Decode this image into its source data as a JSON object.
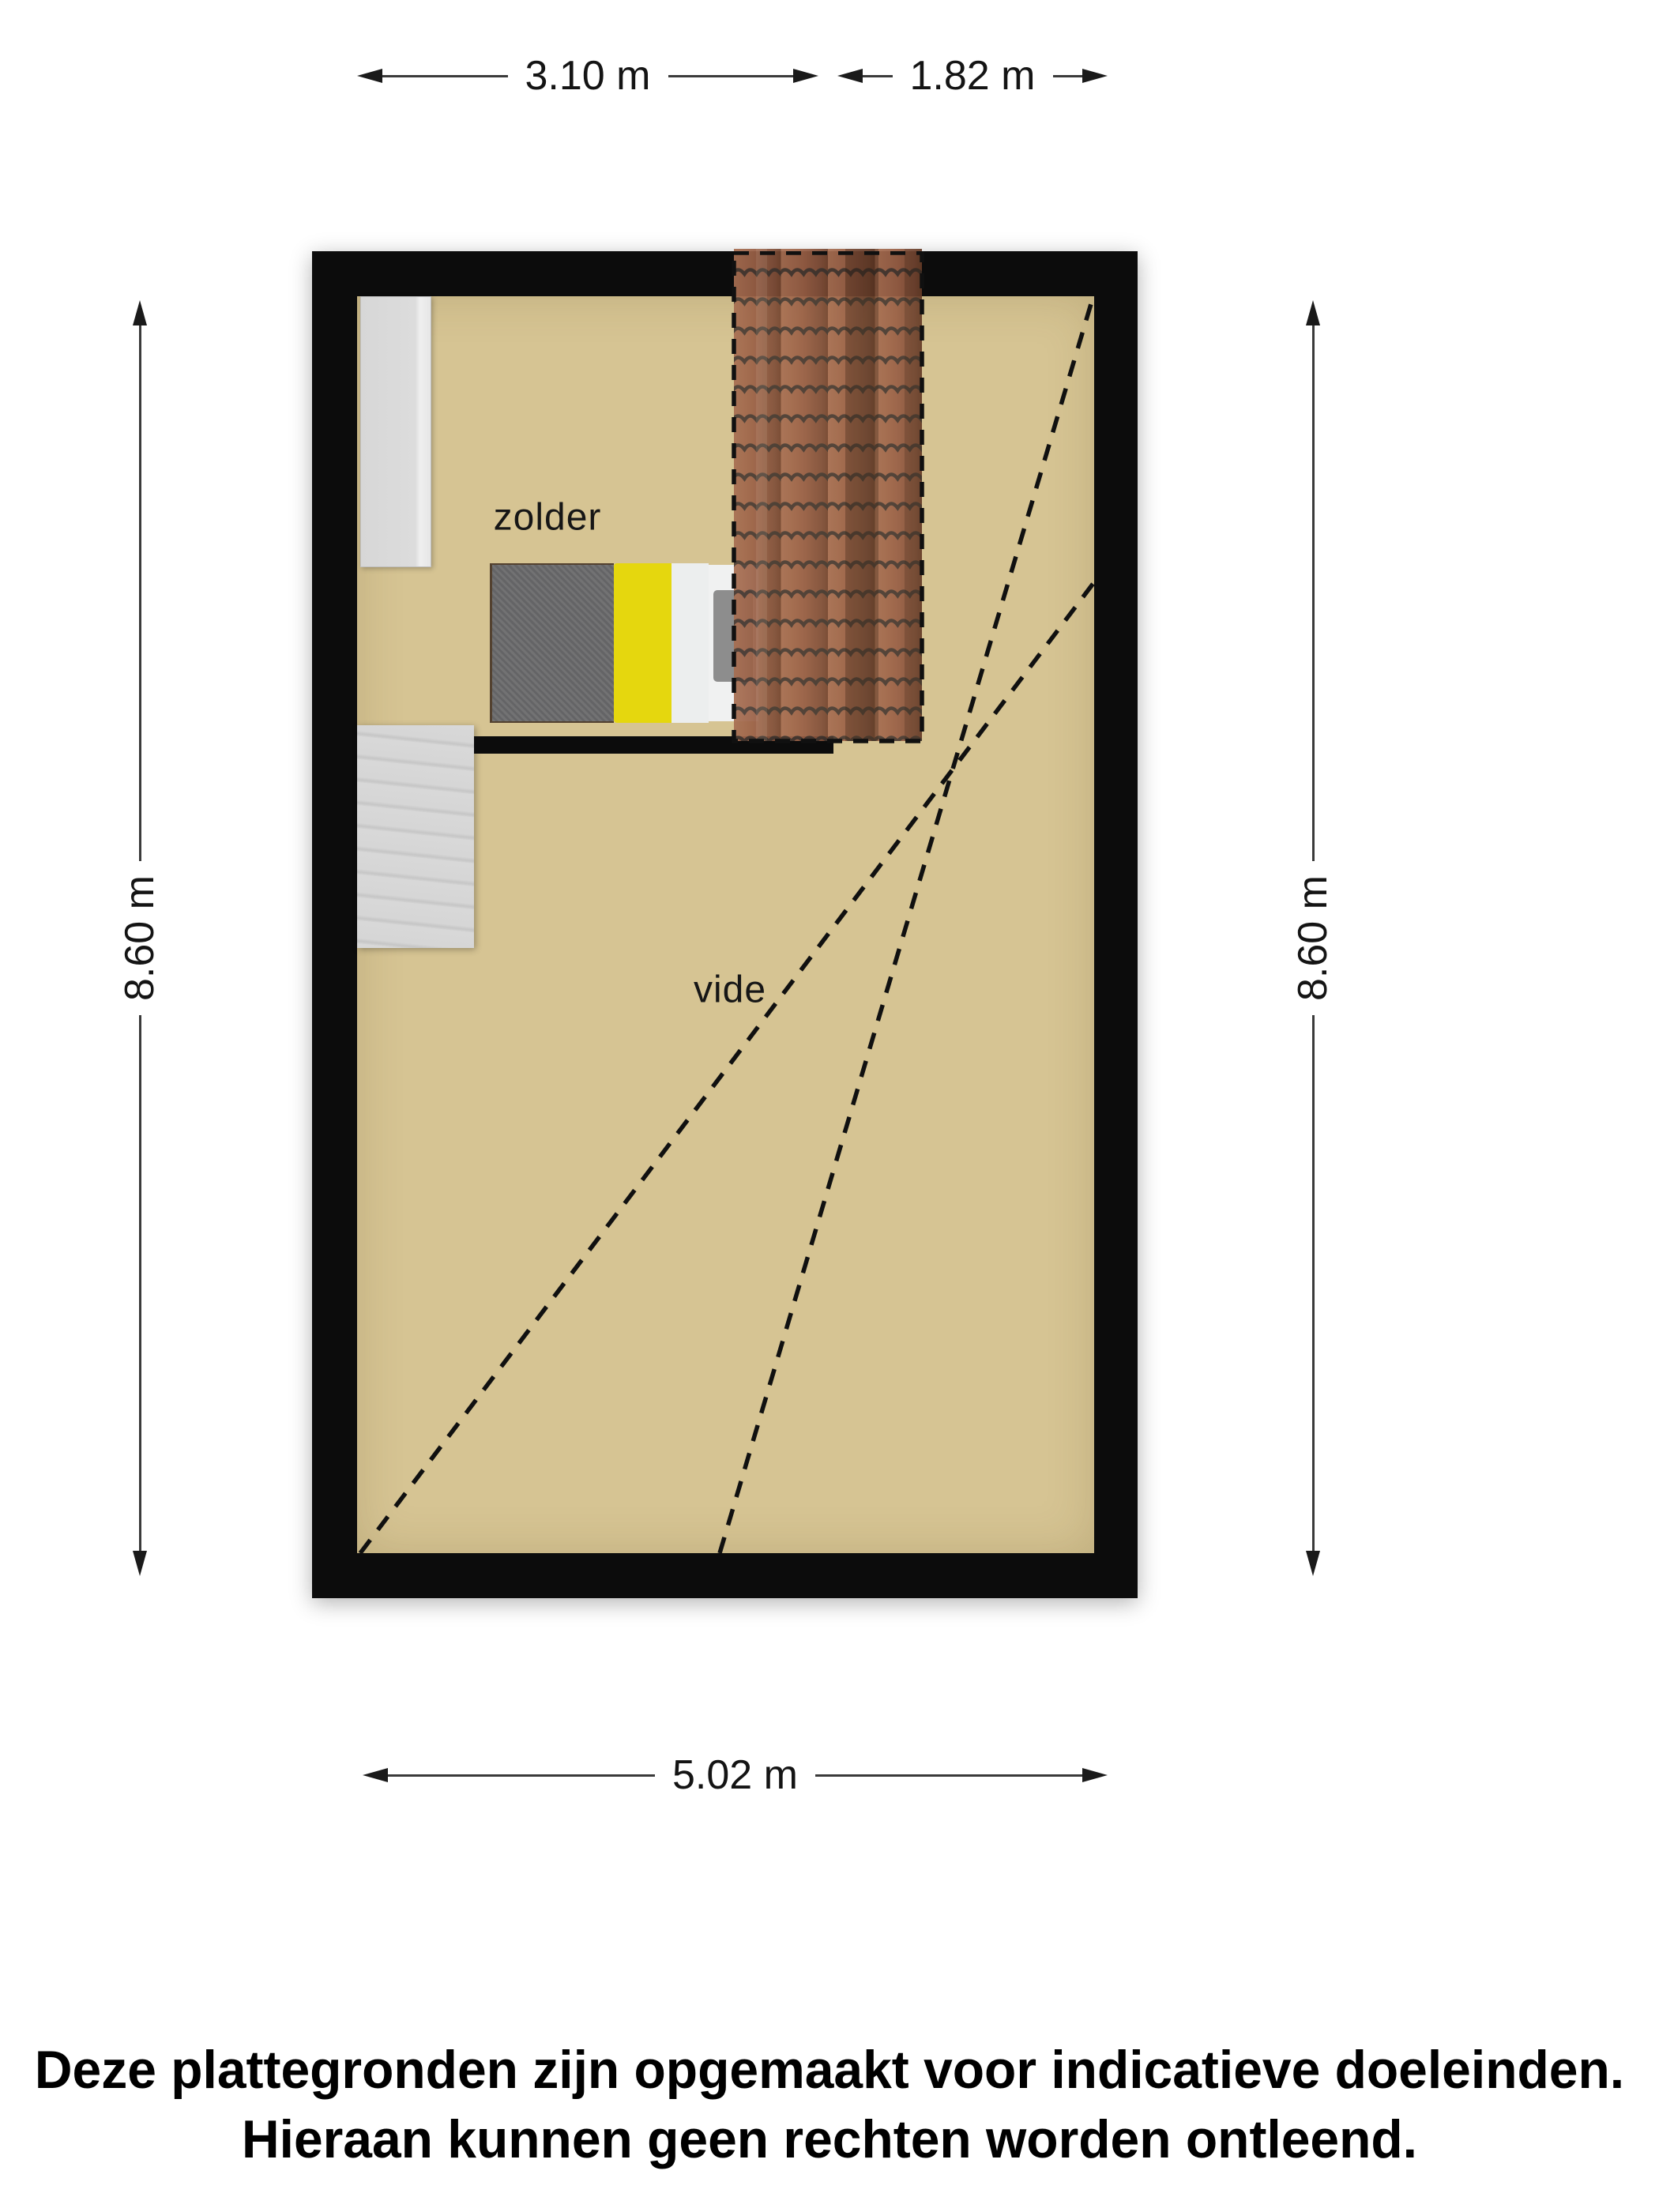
{
  "dimensions": {
    "top_section_width": "3.10 m",
    "top_roof_width": "1.82 m",
    "left_height": "8.60 m",
    "right_height": "8.60 m",
    "bottom_width": "5.02 m"
  },
  "rooms": {
    "attic_label": "zolder",
    "void_label": "vide"
  },
  "disclaimer": {
    "line1": "Deze plattegronden zijn opgemaakt voor indicatieve doeleinden.",
    "line2": "Hieraan kunnen geen rechten worden ontleend."
  },
  "colors": {
    "floor": "#d6c493",
    "wall": "#0c0c0c",
    "roof_tiles_base": "#9a6046",
    "roof_tiles_line": "#3a332e",
    "bed_blanket_yellow": "#e5d70e",
    "bed_duvet_gray": "#6a6a6c",
    "bed_sheet_white": "#eceeee",
    "stairs_gray": "#d3d3d3",
    "closet_gray": "#d9d9d9",
    "dimension_ink": "#1a1a1a"
  }
}
